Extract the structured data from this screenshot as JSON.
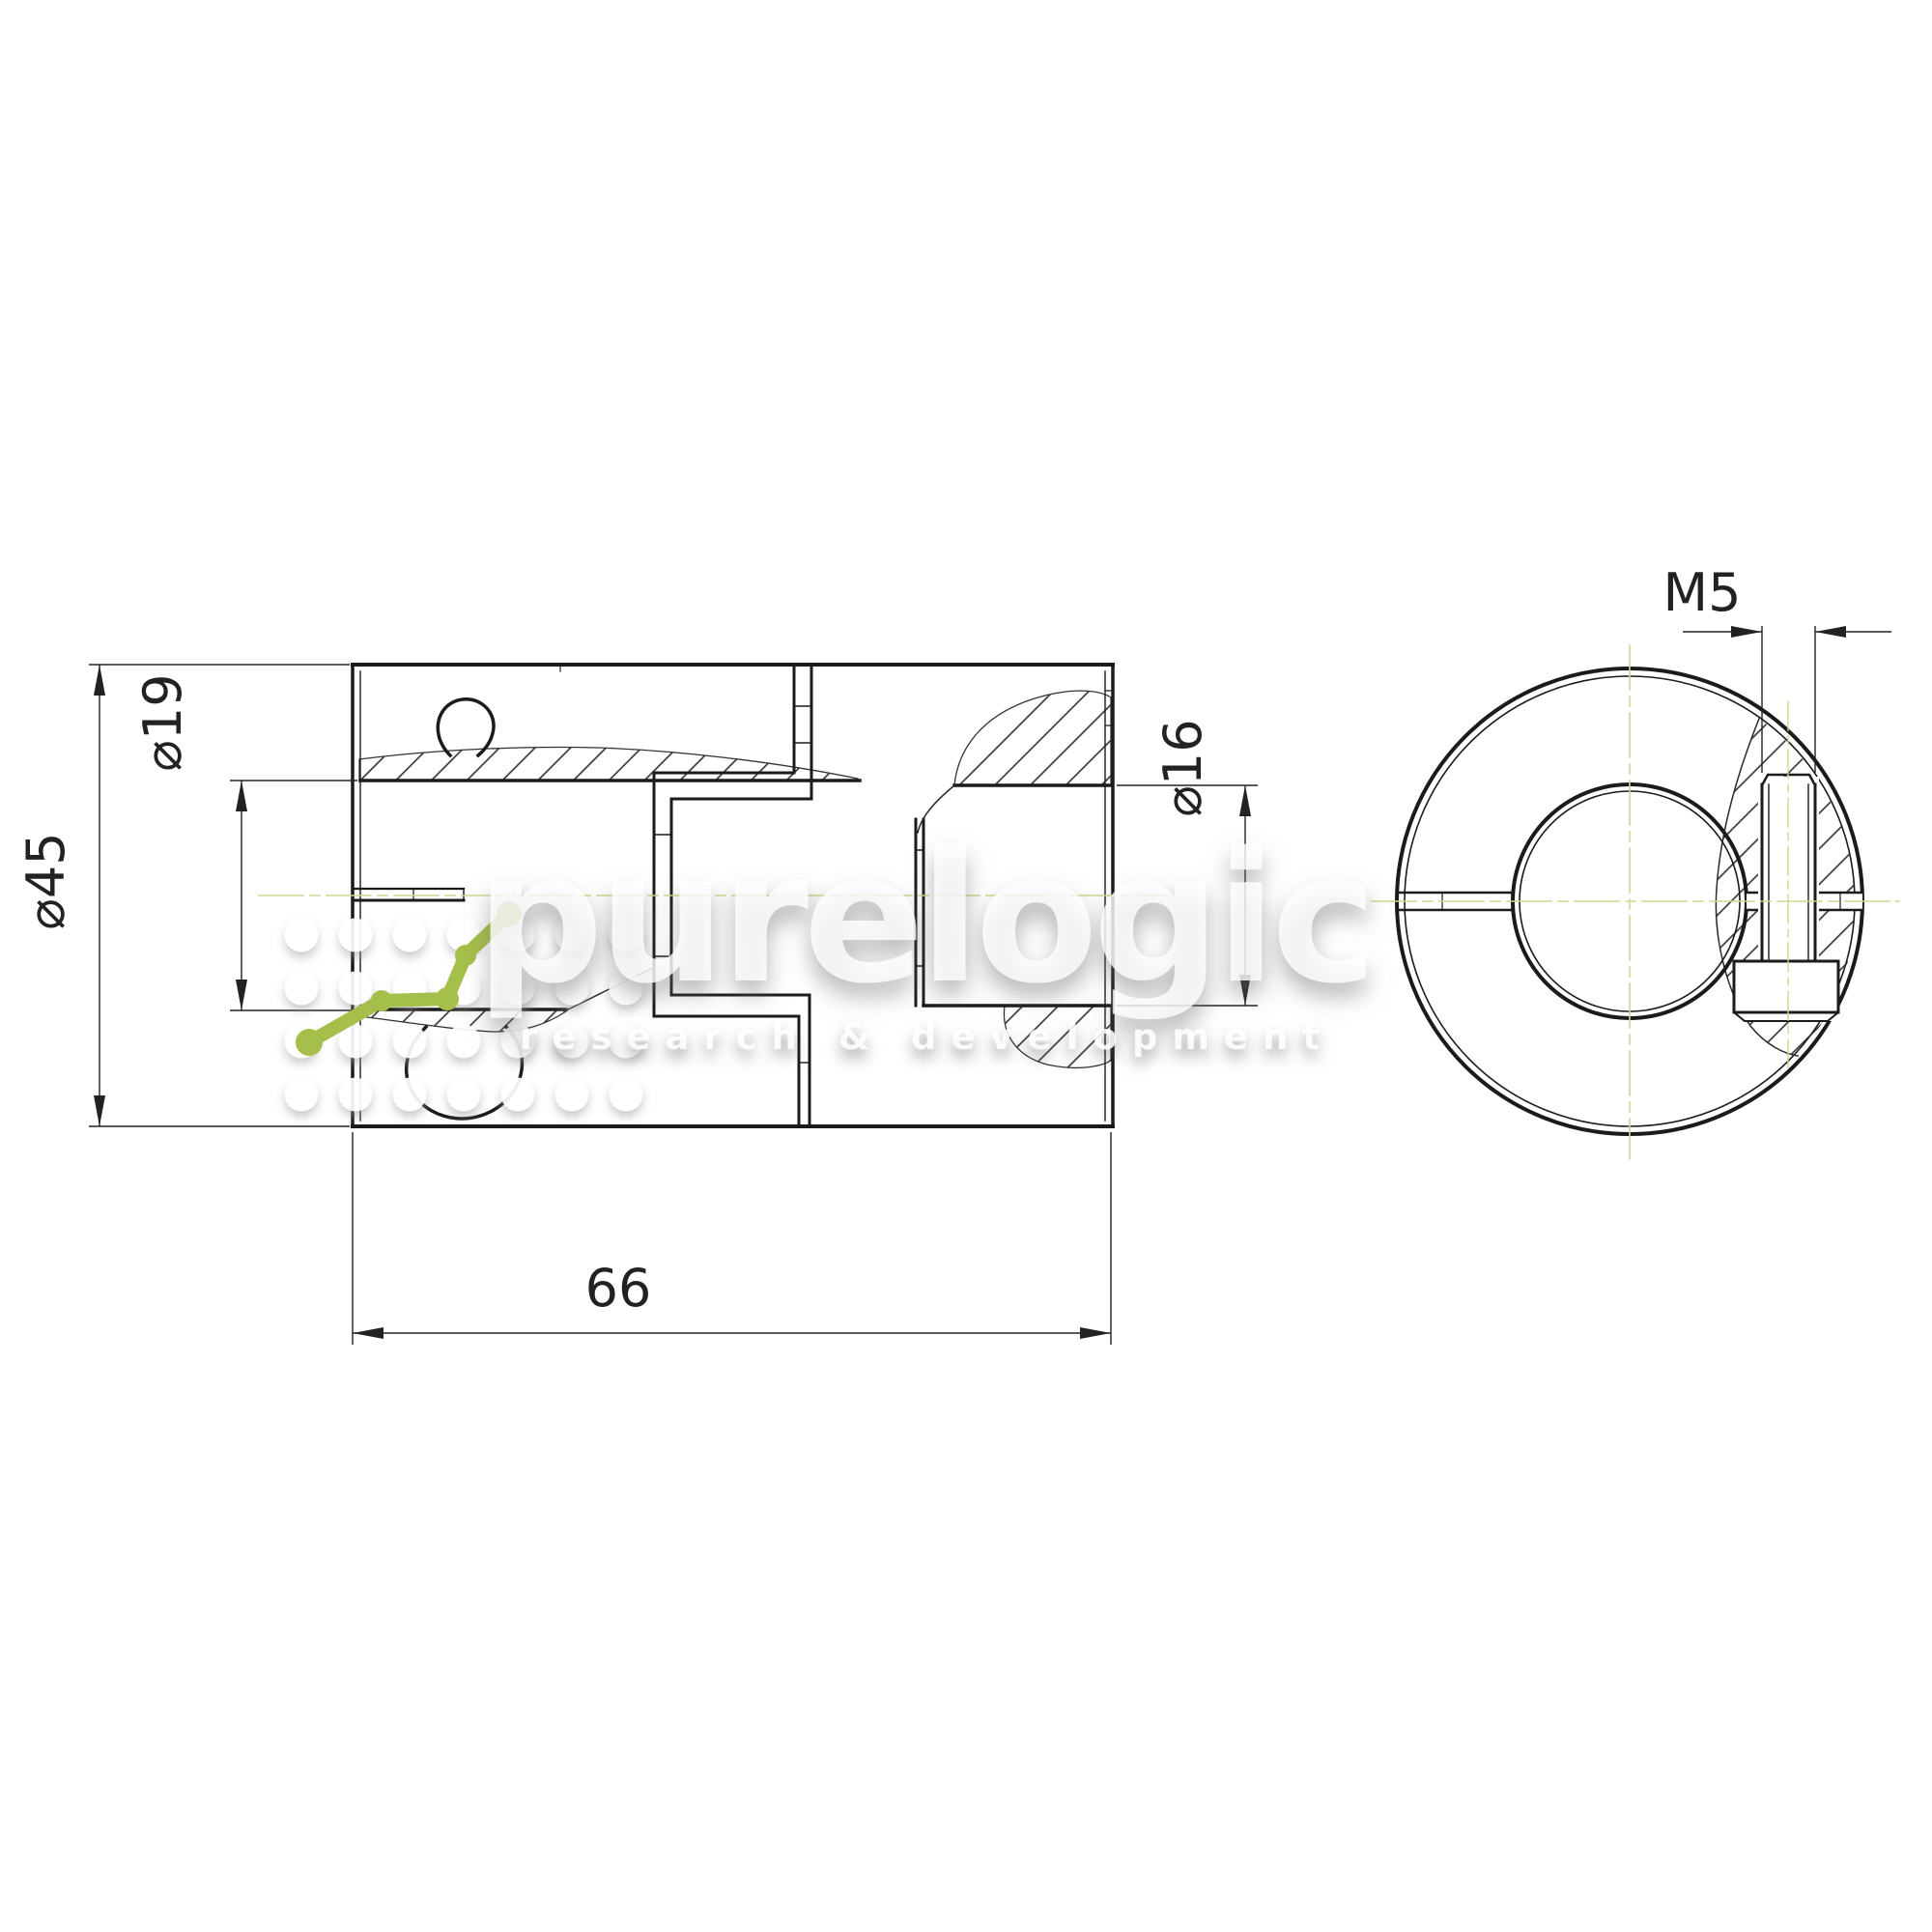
{
  "drawing": {
    "dimensions": {
      "outer_diameter": "⌀45",
      "bore_left": "⌀19",
      "bore_right": "⌀16",
      "overall_length": "66",
      "set_screw_thread": "M5"
    },
    "watermark": {
      "brand": "purelogic",
      "tagline": "research & development"
    },
    "colors": {
      "centerline_green": "#ccd88e",
      "logo_green": "#a4bf4a",
      "ink": "#1b1b1b",
      "dim_ink": "#222222",
      "paper": "#ffffff"
    }
  }
}
